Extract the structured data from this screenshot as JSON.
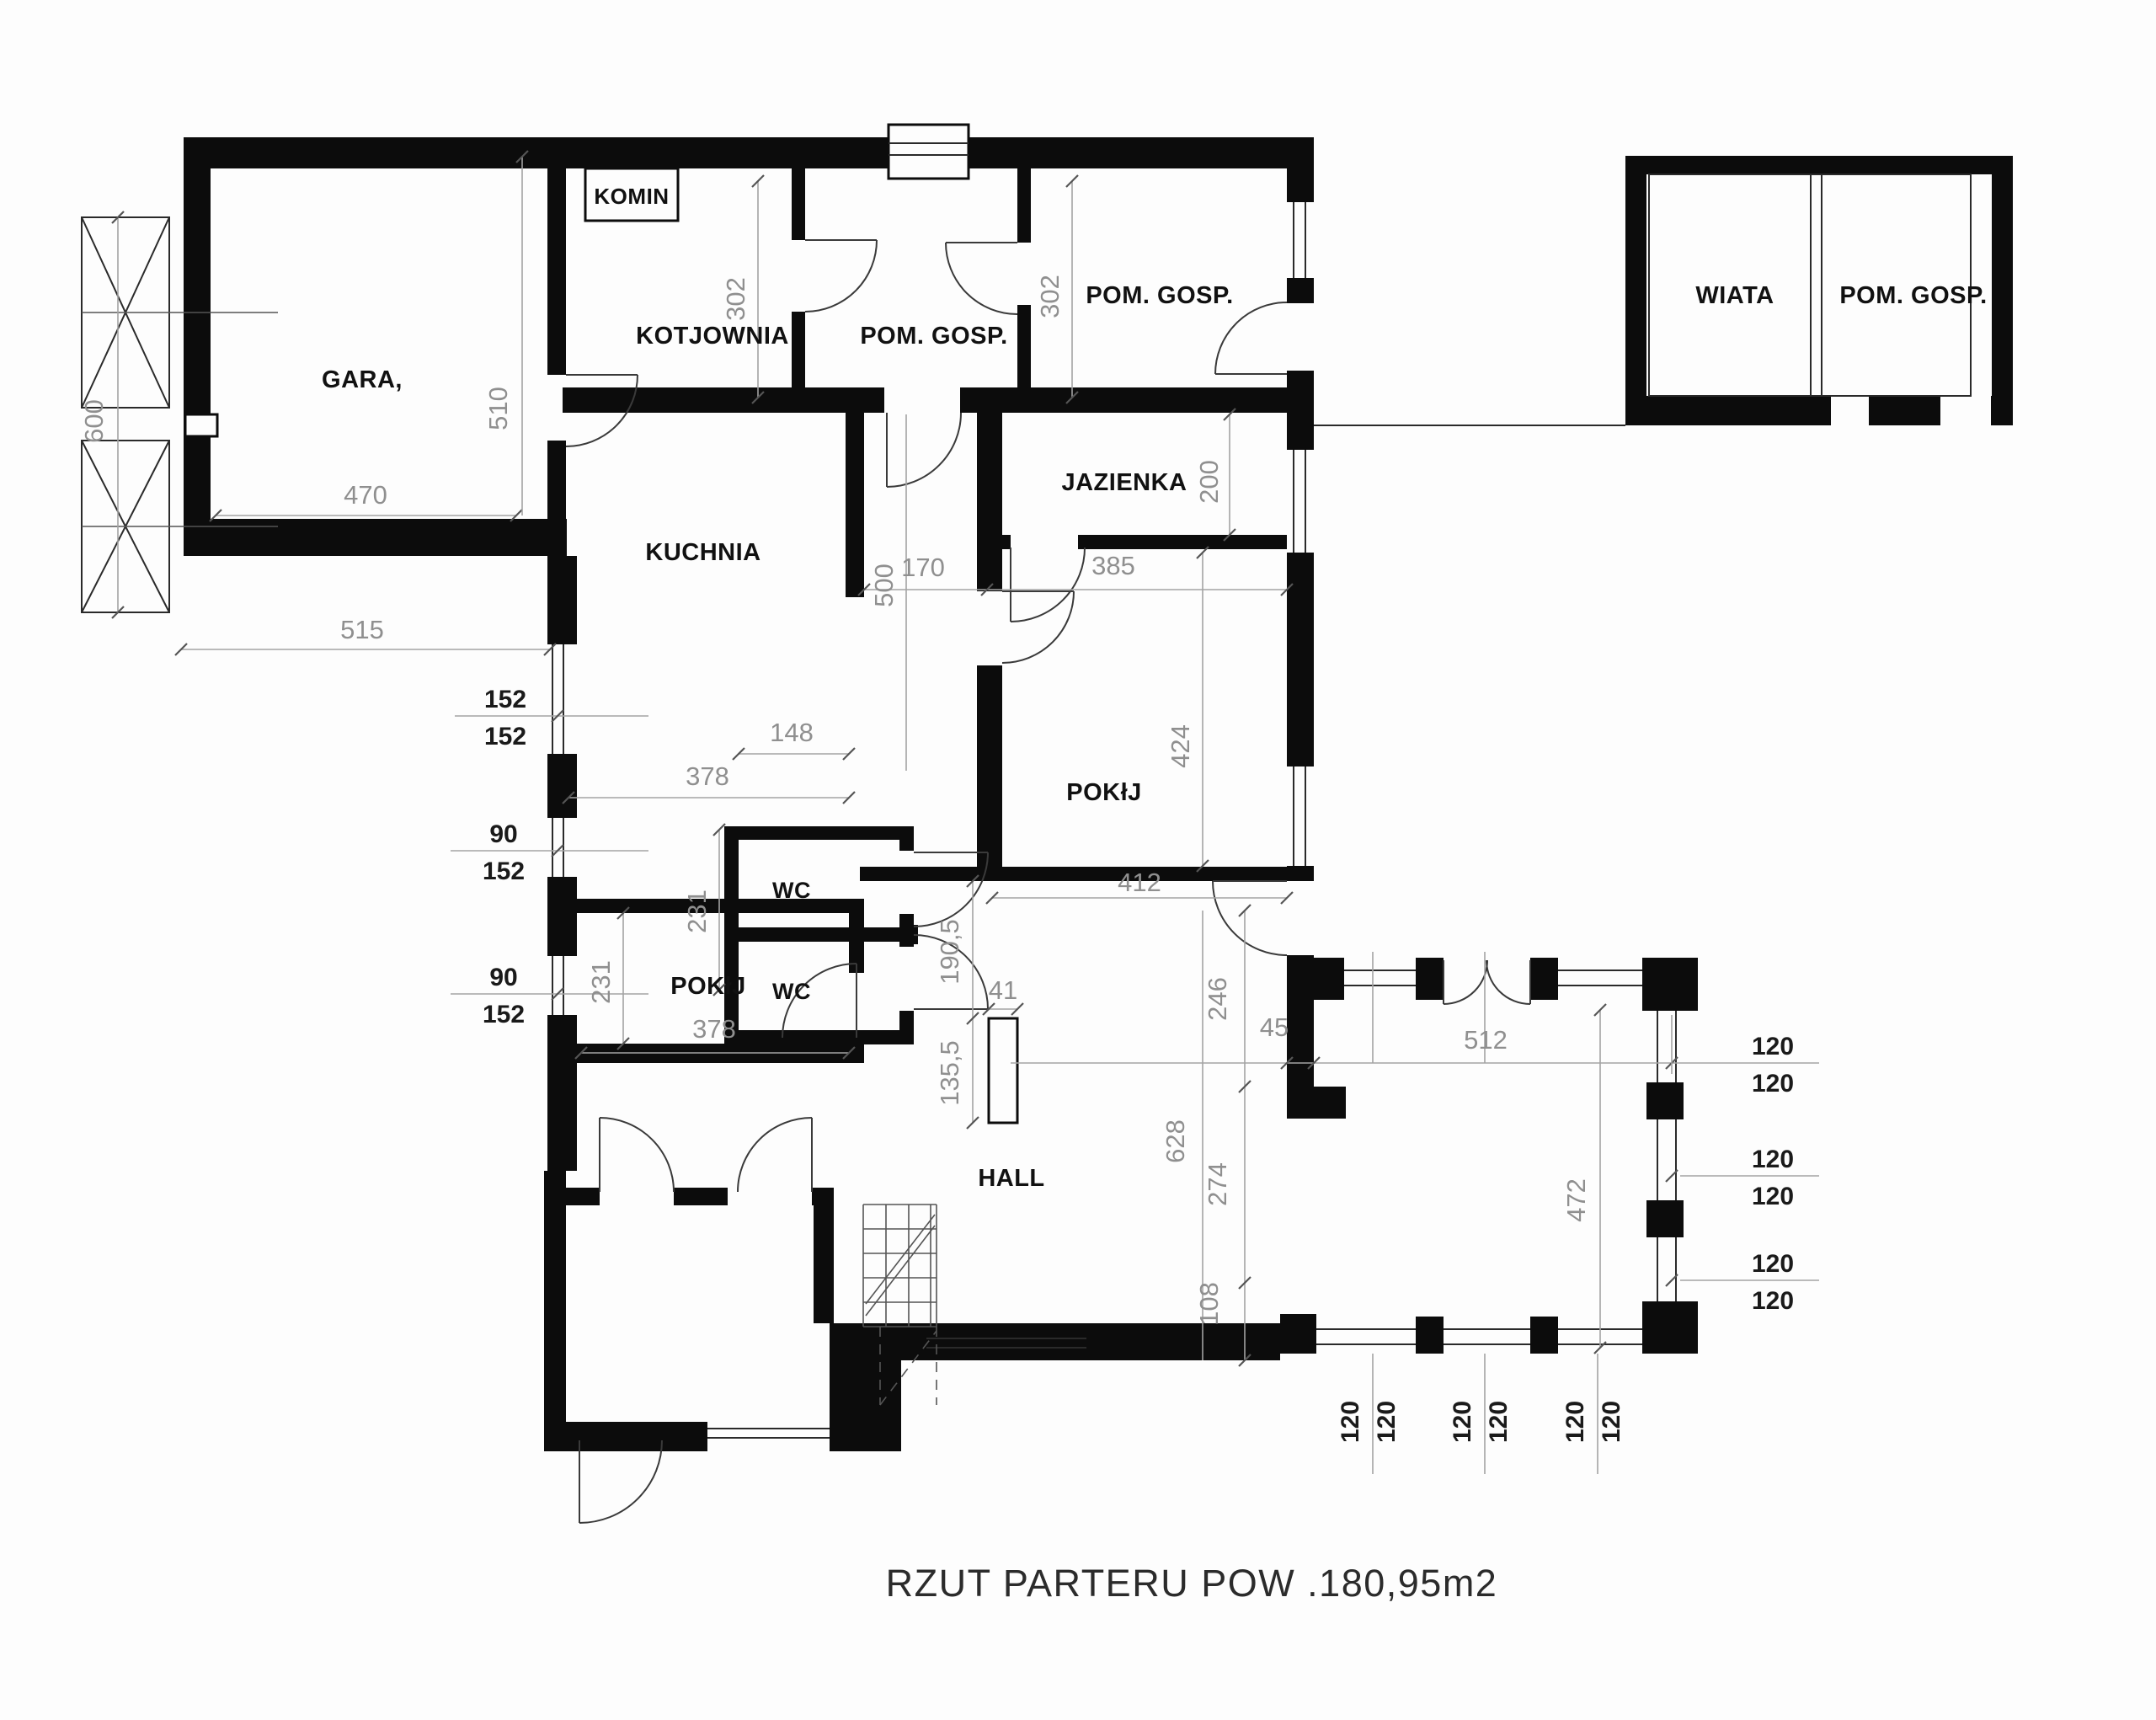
{
  "title": "RZUT PARTERU POW .180,95m2",
  "rooms": {
    "garage": "GARA,",
    "komin": "KOMIN",
    "kotlownia": "KOTJOWNIA",
    "pom_gosp_top_1": "POM. GOSP.",
    "pom_gosp_top_2": "POM. GOSP.",
    "jazienka": "JAZIENKA",
    "kuchnia": "KUCHNIA",
    "wc_1": "WC",
    "wc_2": "WC",
    "pokoj_right": "POKłJ",
    "pokoj_lower": "POKłJ",
    "hall": "HALL",
    "wiata": "WIATA",
    "pom_gosp_wiata": "POM. GOSP."
  },
  "dims": {
    "d600": "600",
    "d470": "470",
    "d510": "510",
    "d515": "515",
    "d302": "302",
    "d152": "152",
    "d90": "90",
    "d120": "120",
    "d500": "500",
    "d148": "148",
    "d378": "378",
    "d231": "231",
    "d170": "170",
    "d385": "385",
    "d200": "200",
    "d424": "424",
    "d412": "412",
    "d190_5": "190,5",
    "d41": "41",
    "d135_5": "135,5",
    "d628": "628",
    "d246": "246",
    "d274": "274",
    "d108": "108",
    "d45": "45",
    "d512": "512",
    "d472": "472"
  },
  "colors": {
    "wall": "#0c0c0c",
    "dim_line": "#a3a3a3",
    "dim_text": "#8f8f8f",
    "fraction_text": "#1a1a1a",
    "background": "#fdfdfd"
  }
}
